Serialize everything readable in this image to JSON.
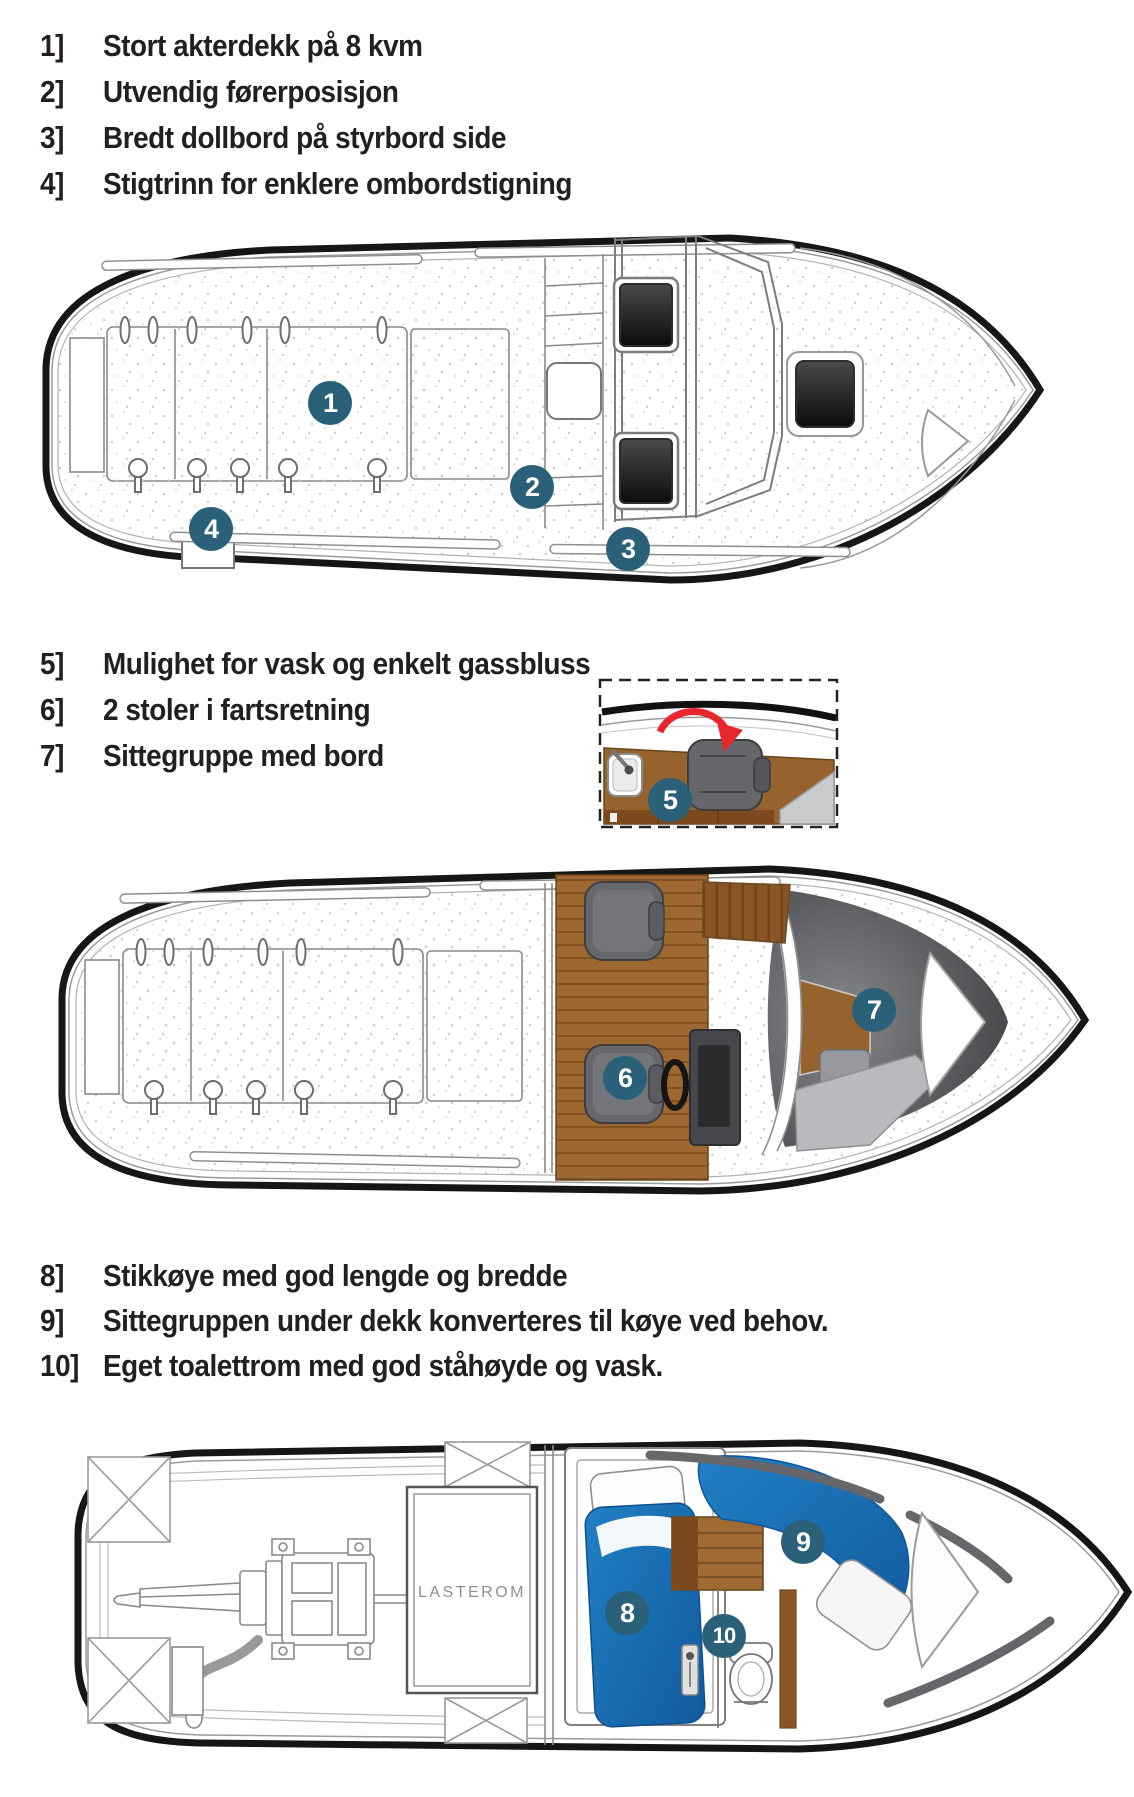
{
  "legend_groups": [
    {
      "items": [
        {
          "num": "1]",
          "text": "Stort akterdekk på 8 kvm"
        },
        {
          "num": "2]",
          "text": "Utvendig førerposisjon"
        },
        {
          "num": "3]",
          "text": "Bredt dollbord på styrbord side"
        },
        {
          "num": "4]",
          "text": "Stigtrinn for enklere ombordstigning"
        }
      ]
    },
    {
      "items": [
        {
          "num": "5]",
          "text": "Mulighet for vask og enkelt gassbluss"
        },
        {
          "num": "6]",
          "text": "2 stoler i fartsretning"
        },
        {
          "num": "7]",
          "text": "Sittegruppe med bord"
        }
      ]
    },
    {
      "items": [
        {
          "num": "8]",
          "text": "Stikkøye med god lengde og bredde"
        },
        {
          "num": "9]",
          "text": "Sittegruppen under dekk konverteres til køye ved behov."
        },
        {
          "num": "10]",
          "text": "Eget toalettrom med god ståhøyde og vask."
        }
      ]
    }
  ],
  "markers": [
    {
      "label": "1"
    },
    {
      "label": "2"
    },
    {
      "label": "3"
    },
    {
      "label": "4"
    },
    {
      "label": "5"
    },
    {
      "label": "6"
    },
    {
      "label": "7"
    },
    {
      "label": "8"
    },
    {
      "label": "9"
    },
    {
      "label": "10"
    }
  ],
  "boat3": {
    "cargo_label": "LASTEROM"
  },
  "colors": {
    "marker_teal": "#2a6078",
    "berth_blue": "#1b75bb",
    "wood_brown": "#99652f",
    "wood_dark": "#7c4a1e",
    "seat_gray": "#6d6e71",
    "arrow_red": "#e8262d",
    "hull_black": "#161616"
  }
}
